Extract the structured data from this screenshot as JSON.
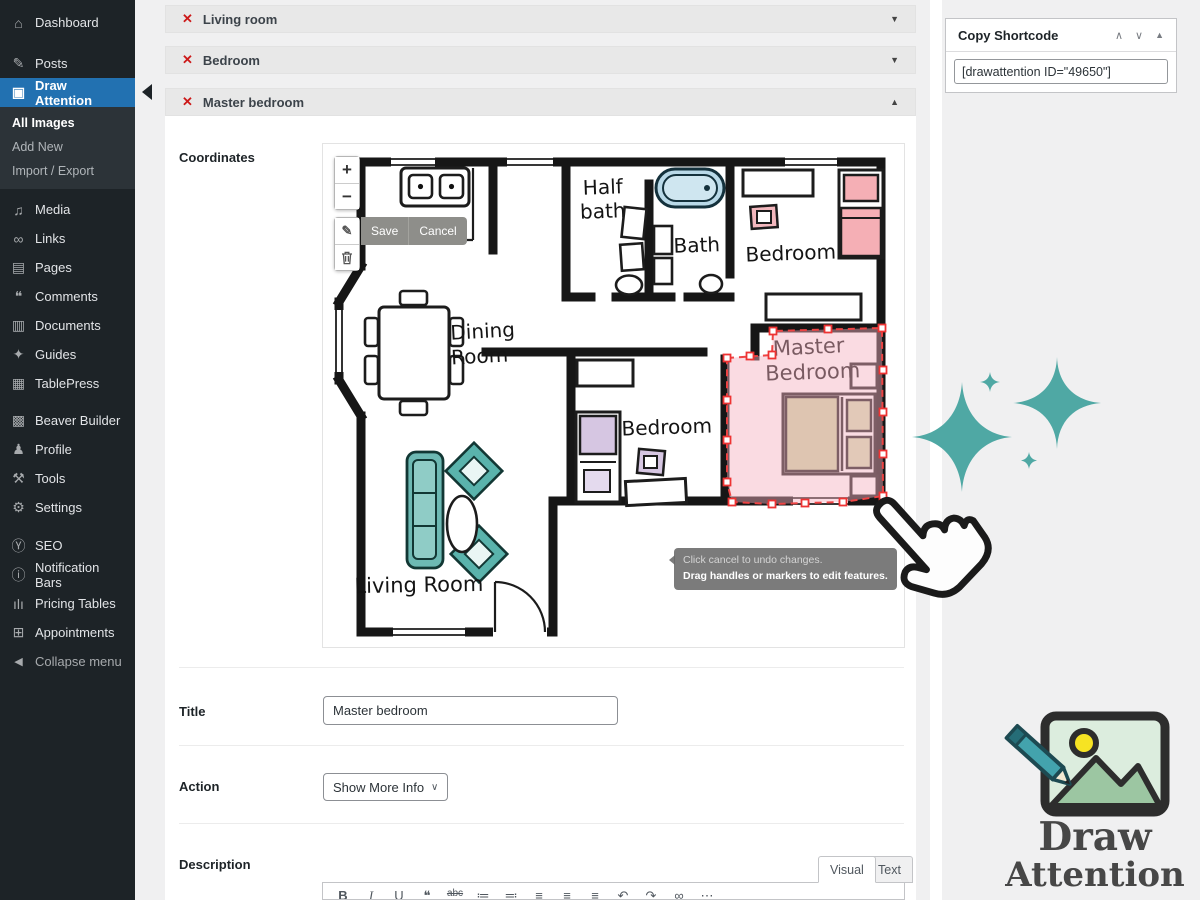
{
  "sidebar": {
    "items": [
      {
        "label": "Dashboard",
        "icon": "dashboard"
      },
      {
        "label": "Posts",
        "icon": "posts"
      },
      {
        "label": "Draw Attention",
        "icon": "draw_attention"
      },
      {
        "label": "Media",
        "icon": "media"
      },
      {
        "label": "Links",
        "icon": "links"
      },
      {
        "label": "Pages",
        "icon": "pages"
      },
      {
        "label": "Comments",
        "icon": "comments"
      },
      {
        "label": "Documents",
        "icon": "documents"
      },
      {
        "label": "Guides",
        "icon": "guides"
      },
      {
        "label": "TablePress",
        "icon": "tablepress"
      },
      {
        "label": "Beaver Builder",
        "icon": "beaver_builder"
      },
      {
        "label": "Profile",
        "icon": "profile"
      },
      {
        "label": "Tools",
        "icon": "tools"
      },
      {
        "label": "Settings",
        "icon": "settings"
      },
      {
        "label": "SEO",
        "icon": "seo"
      },
      {
        "label": "Notification Bars",
        "icon": "notification_bars"
      },
      {
        "label": "Pricing Tables",
        "icon": "pricing_tables"
      },
      {
        "label": "Appointments",
        "icon": "appointments"
      }
    ],
    "submenu": [
      "All Images",
      "Add New",
      "Import / Export"
    ],
    "collapse_label": "Collapse menu"
  },
  "icons": {
    "dashboard": "⌂",
    "posts": "✎",
    "draw_attention": "▣",
    "media": "♫",
    "links": "∞",
    "pages": "▤",
    "comments": "❝",
    "documents": "▥",
    "guides": "✦",
    "tablepress": "▦",
    "beaver_builder": "▩",
    "profile": "♟",
    "tools": "⚒",
    "settings": "⚙",
    "seo": "Ⓨ",
    "notification_bars": "ⓘ",
    "pricing_tables": "ılı",
    "appointments": "⊞",
    "collapse": "◀",
    "remove_x": "✕",
    "accordion_collapsed": "▼",
    "accordion_expanded": "▲",
    "chevron_up": "∧",
    "chevron_down": "∨",
    "postbox_toggle": "▲",
    "select_caret": "∨",
    "zoom_in": "+",
    "zoom_out": "−",
    "edit": "✎"
  },
  "accordions": [
    {
      "label": "Living room"
    },
    {
      "label": "Bedroom"
    },
    {
      "label": "Master bedroom"
    }
  ],
  "panel": {
    "coordinates_label": "Coordinates",
    "title_label": "Title",
    "title_value": "Master bedroom",
    "action_label": "Action",
    "action_value": "Show More Info",
    "description_label": "Description",
    "visual_tab": "Visual",
    "text_tab": "Text"
  },
  "map": {
    "save_label": "Save",
    "cancel_label": "Cancel",
    "tooltip_line1": "Click cancel to undo changes.",
    "tooltip_line2": "Drag handles or markers to edit features."
  },
  "plan": {
    "kitchen": "Kitchen",
    "half_bath_1": "Half",
    "half_bath_2": "bath",
    "bath": "Bath",
    "bedroom_top": "Bedroom",
    "dining_1": "Dining",
    "dining_2": "Room",
    "bedroom_mid": "Bedroom",
    "master_1": "Master",
    "master_2": "Bedroom",
    "living": "Living  Room"
  },
  "shortcode": {
    "title": "Copy Shortcode",
    "value": "[drawattention ID=\"49650\"]"
  },
  "branding": {
    "word1": "Draw",
    "word2": "Attention"
  },
  "editor_icons": [
    {
      "name": "bold",
      "glyph": "B"
    },
    {
      "name": "italic",
      "glyph": "I"
    },
    {
      "name": "underline",
      "glyph": "U"
    },
    {
      "name": "blockquote",
      "glyph": "❝"
    },
    {
      "name": "strikethrough",
      "glyph": "abc"
    },
    {
      "name": "bulleted-list",
      "glyph": "≔"
    },
    {
      "name": "numbered-list",
      "glyph": "≕"
    },
    {
      "name": "align-left",
      "glyph": "≡"
    },
    {
      "name": "align-center",
      "glyph": "≡"
    },
    {
      "name": "align-right",
      "glyph": "≡"
    },
    {
      "name": "undo",
      "glyph": "↶"
    },
    {
      "name": "redo",
      "glyph": "↷"
    },
    {
      "name": "link",
      "glyph": "∞"
    },
    {
      "name": "more",
      "glyph": "⋯"
    }
  ],
  "colors": {
    "accent_blue": "#2271b1",
    "sidebar_bg": "#1d2327",
    "teal": "#4fa8a4",
    "selection_red": "#ee4444",
    "selection_fill": "#f3b0be",
    "danger_red": "#cc1818"
  }
}
